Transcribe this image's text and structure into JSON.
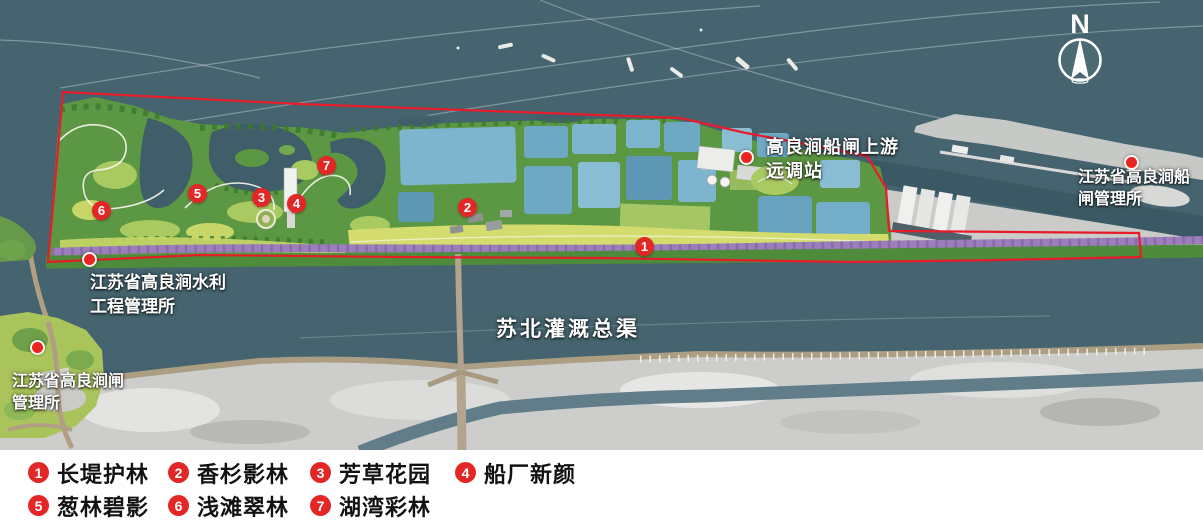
{
  "colors": {
    "water": "#45646f",
    "park_green": "#5c9743",
    "pond_blue": "#74aeca",
    "road_purple": "#9c7fba",
    "boundary_red": "#e81b2a",
    "marker_red": "#e32726",
    "industrial_gray": "#cdcecb",
    "legend_text": "#121212"
  },
  "map": {
    "compass_label": "N",
    "canal_label": "苏北灌溉总渠",
    "labels": {
      "upstream_station": {
        "line1": "高良涧船闸上游",
        "line2": "远调站"
      },
      "ship_lock_office": {
        "line1": "江苏省高良涧船",
        "line2": "闸管理所"
      },
      "water_works_office": {
        "line1": "江苏省高良涧水利",
        "line2": "工程管理所"
      },
      "sluice_office": {
        "line1": "江苏省高良涧闸",
        "line2": "管理所"
      }
    },
    "markers": [
      {
        "number": "1"
      },
      {
        "number": "2"
      },
      {
        "number": "3"
      },
      {
        "number": "4"
      },
      {
        "number": "5"
      },
      {
        "number": "6"
      },
      {
        "number": "7"
      }
    ]
  },
  "legend": {
    "items": [
      {
        "number": "1",
        "label": "长堤护林"
      },
      {
        "number": "2",
        "label": "香杉影林"
      },
      {
        "number": "3",
        "label": "芳草花园"
      },
      {
        "number": "4",
        "label": "船厂新颜"
      },
      {
        "number": "5",
        "label": "葱林碧影"
      },
      {
        "number": "6",
        "label": "浅滩翠林"
      },
      {
        "number": "7",
        "label": "湖湾彩林"
      }
    ]
  }
}
